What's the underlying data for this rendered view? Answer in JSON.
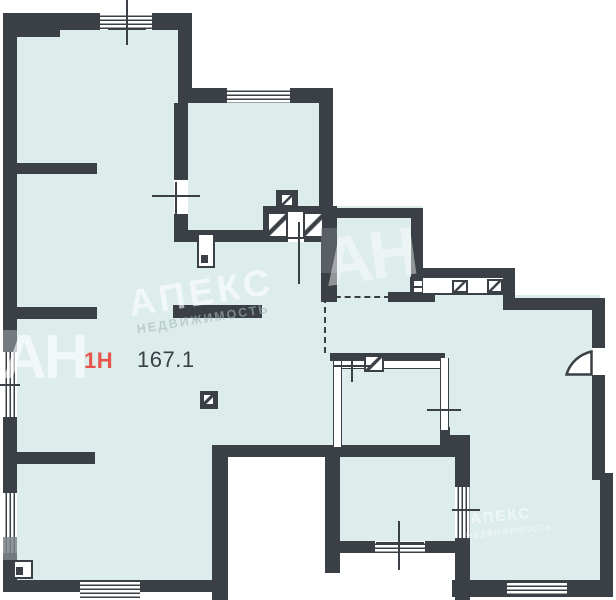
{
  "plan": {
    "unit_label": "1Н",
    "area_value": "167.1",
    "colors": {
      "wall": "#3b4046",
      "room": "#dcedeb",
      "accent": "#e8544b",
      "white": "#ffffff"
    },
    "watermark": {
      "logo": "АН",
      "brand": "АПЕКС",
      "brand_sub": "НЕДВИЖИМОСТЬ"
    }
  }
}
